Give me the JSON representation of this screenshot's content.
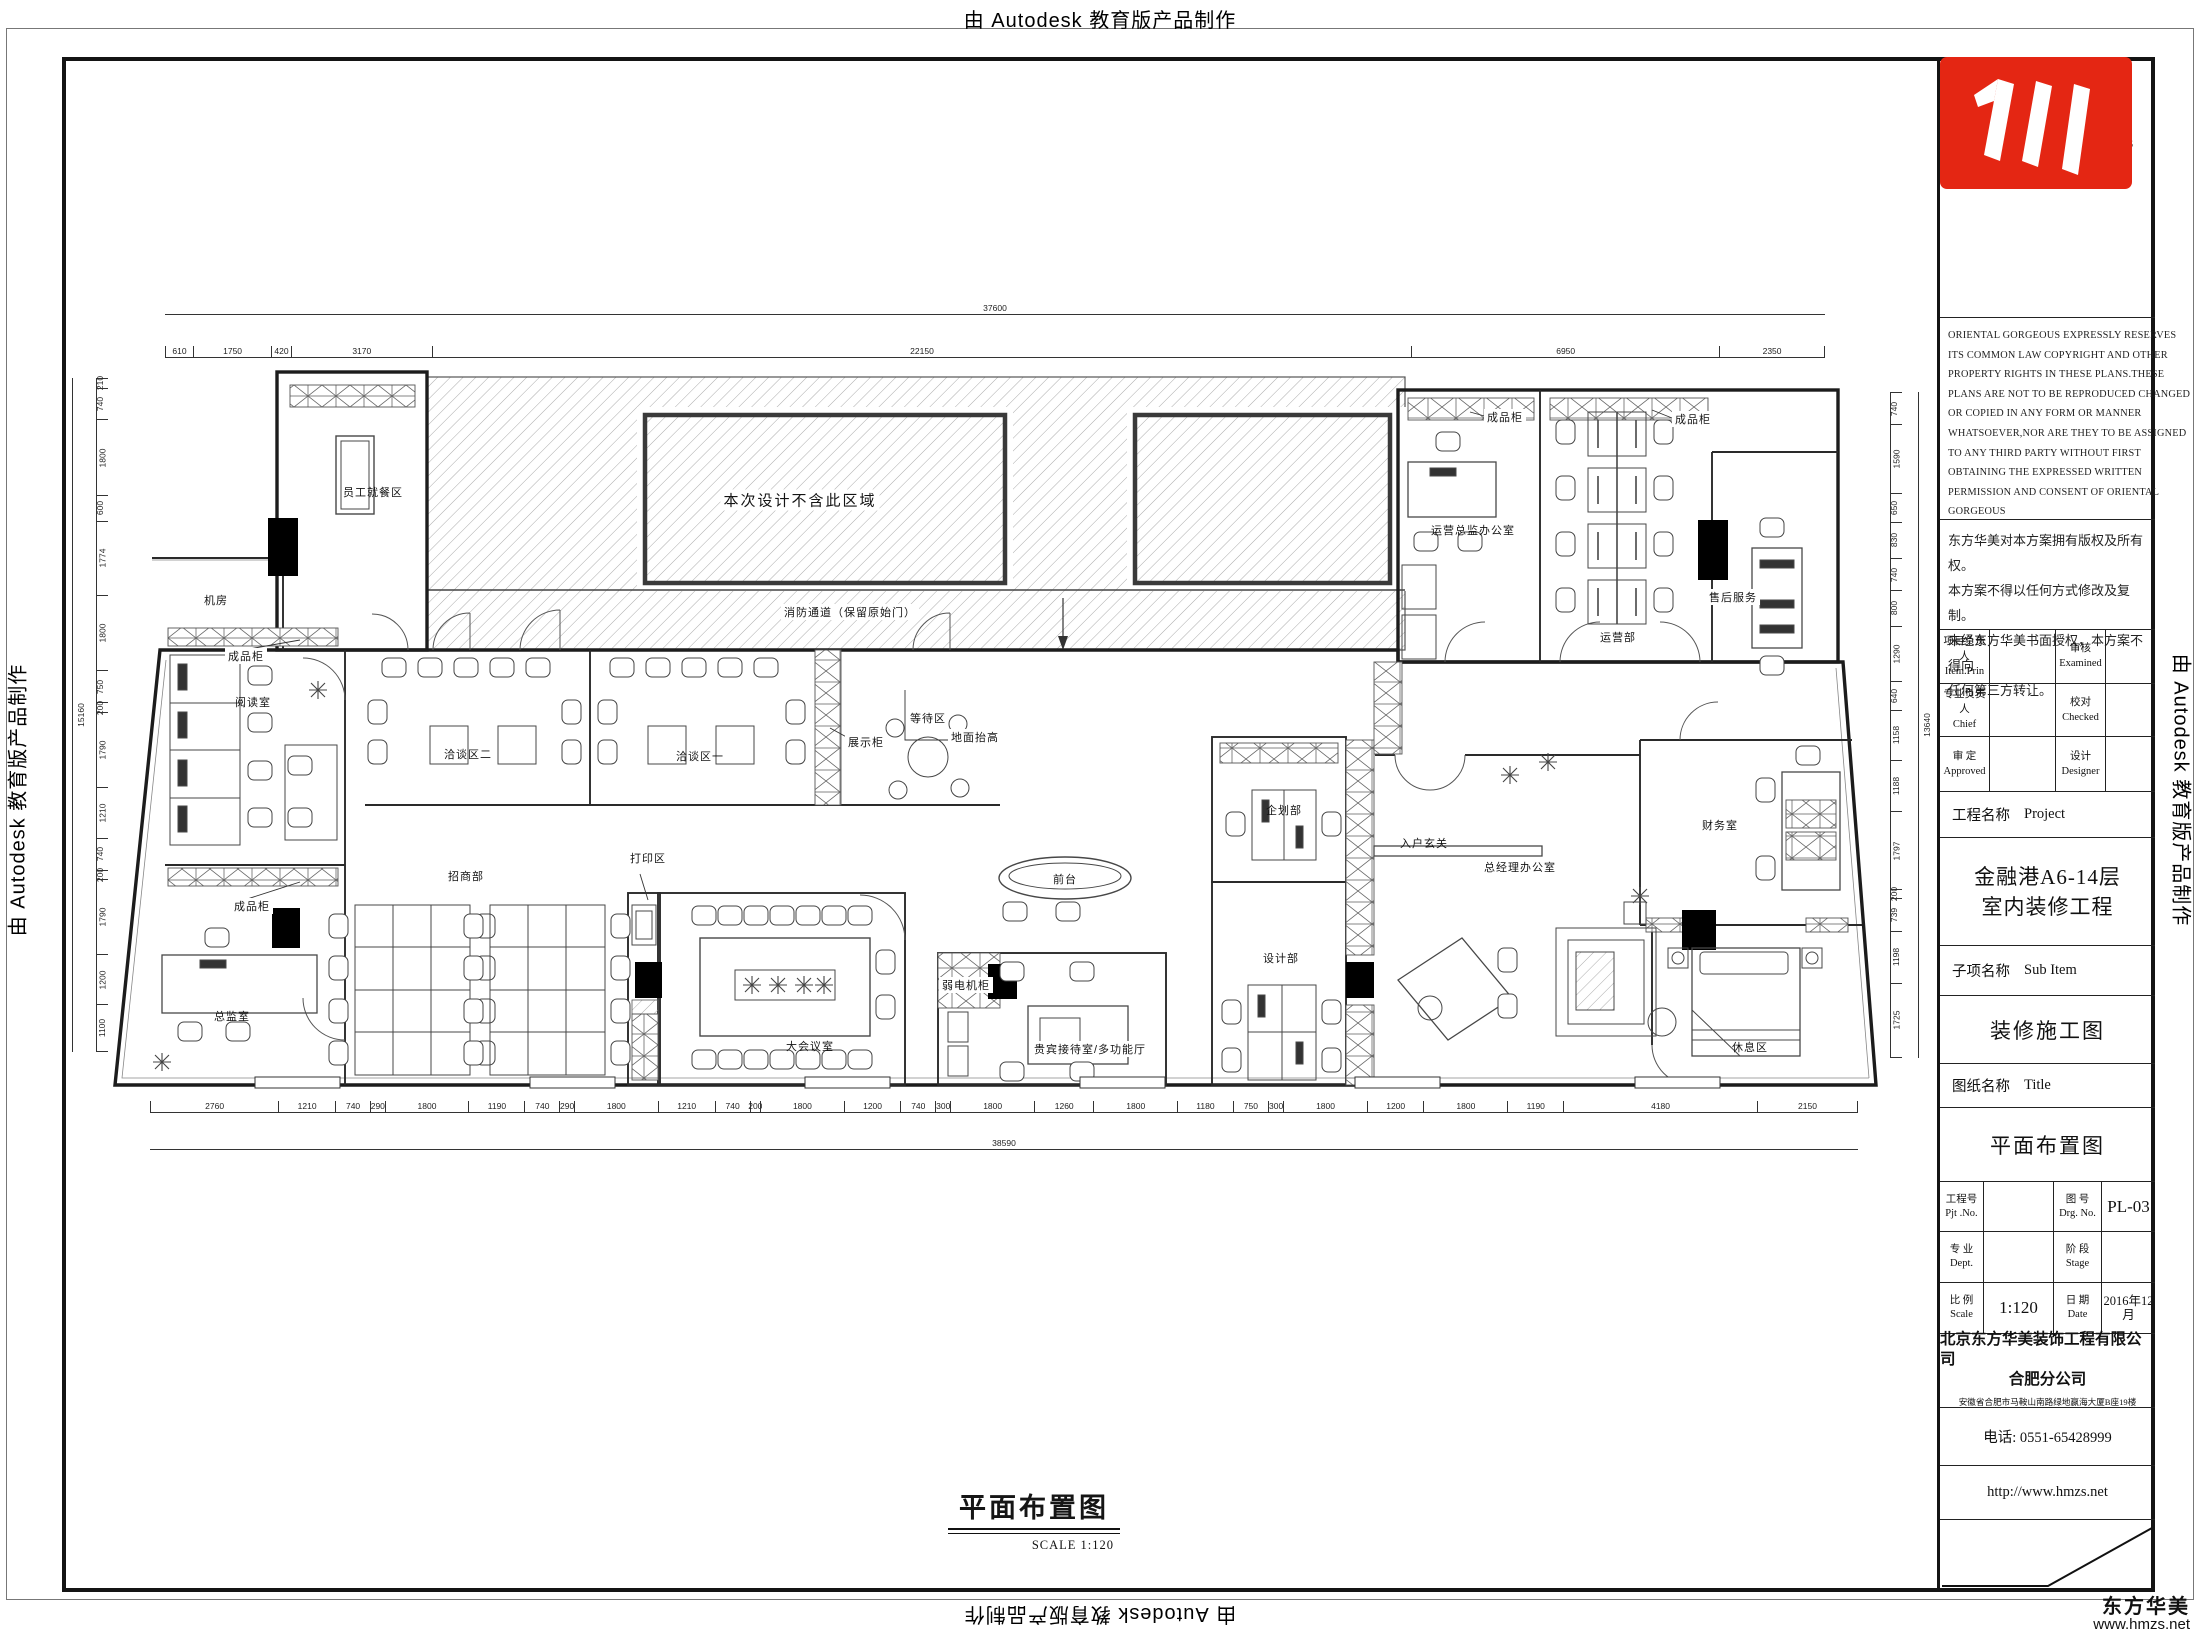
{
  "page": {
    "autodesk_credit": "由 Autodesk 教育版产品制作",
    "watermark_brand": "东方华美",
    "watermark_url": "www.hmzs.net"
  },
  "titleblock": {
    "logo_cn": "东方华美",
    "logo_en": "Oriental Gorgeous",
    "copyright_en_lines": [
      "ORIENTAL GORGEOUS EXPRESSLY RESERVES",
      "ITS COMMON LAW COPYRIGHT AND OTHER",
      "PROPERTY RIGHTS IN THESE PLANS.THESE",
      "PLANS ARE NOT TO BE REPRODUCED CHANGED",
      "OR COPIED IN ANY FORM OR MANNER",
      "WHATSOEVER,NOR ARE THEY TO BE ASSIGNED",
      "TO ANY THIRD PARTY WITHOUT FIRST",
      "OBTAINING THE EXPRESSED WRITTEN",
      "PERMISSION AND CONSENT OF ORIENTAL",
      "GORGEOUS"
    ],
    "copyright_cn_lines": [
      "东方华美对本方案拥有版权及所有权。",
      "本方案不得以任何方式修改及复制。",
      "未经东方华美书面授权，本方案不得向",
      "任何第三方转让。"
    ],
    "personnel": [
      {
        "l_cn": "项目负责人",
        "l_en": "Item.Prin",
        "l_val": "",
        "r_cn": "审核",
        "r_en": "Examined",
        "r_val": ""
      },
      {
        "l_cn": "专业负责人",
        "l_en": "Chief",
        "l_val": "",
        "r_cn": "校对",
        "r_en": "Checked",
        "r_val": ""
      },
      {
        "l_cn": "审 定",
        "l_en": "Approved",
        "l_val": "",
        "r_cn": "设计",
        "r_en": "Designer",
        "r_val": ""
      }
    ],
    "project_label_cn": "工程名称",
    "project_label_en": "Project",
    "project_name_line1": "金融港A6-14层",
    "project_name_line2": "室内装修工程",
    "subitem_label_cn": "子项名称",
    "subitem_label_en": "Sub Item",
    "subitem_name": "装修施工图",
    "sheet_label_cn": "图纸名称",
    "sheet_label_en": "Title",
    "sheet_name": "平面布置图",
    "meta": {
      "pjt_cn": "工程号",
      "pjt_en": "Pjt .No.",
      "pjt_value": "",
      "drg_cn": "图 号",
      "drg_en": "Drg. No.",
      "drg_value": "PL-03",
      "dept_cn": "专 业",
      "dept_en": "Dept.",
      "dept_value": "",
      "stage_cn": "阶 段",
      "stage_en": "Stage",
      "stage_value": "",
      "scale_cn": "比 例",
      "scale_en": "Scale",
      "scale_value": "1:120",
      "date_cn": "日 期",
      "date_en": "Date",
      "date_value": "2016年12月"
    },
    "company_line1": "北京东方华美装饰工程有限公司",
    "company_line2": "合肥分公司",
    "company_address": "安徽省合肥市马鞍山南路绿地赢海大厦B座19楼",
    "phone": "电话: 0551-65428999",
    "website": "http://www.hmzs.net",
    "brand_red": "#e42613"
  },
  "plan": {
    "footer_title": "平面布置图",
    "footer_scale": "SCALE  1:120",
    "labels": [
      {
        "text": "本次设计不含此区域",
        "x": 800,
        "y": 500,
        "bg": true,
        "big": true
      },
      {
        "text": "消防通道（保留原始门）",
        "x": 850,
        "y": 612,
        "bg": true
      },
      {
        "text": "员工就餐区",
        "x": 373,
        "y": 492
      },
      {
        "text": "机房",
        "x": 216,
        "y": 600
      },
      {
        "text": "成品柜",
        "x": 246,
        "y": 656,
        "bg": true
      },
      {
        "text": "阅读室",
        "x": 253,
        "y": 702
      },
      {
        "text": "成品柜",
        "x": 252,
        "y": 906,
        "bg": true
      },
      {
        "text": "总监室",
        "x": 232,
        "y": 1016
      },
      {
        "text": "招商部",
        "x": 466,
        "y": 876
      },
      {
        "text": "洽谈区二",
        "x": 468,
        "y": 754
      },
      {
        "text": "洽谈区一",
        "x": 700,
        "y": 756
      },
      {
        "text": "展示柜",
        "x": 866,
        "y": 742,
        "bg": true
      },
      {
        "text": "等待区",
        "x": 928,
        "y": 718
      },
      {
        "text": "打印区",
        "x": 648,
        "y": 858,
        "bg": true
      },
      {
        "text": "大会议室",
        "x": 810,
        "y": 1046
      },
      {
        "text": "前台",
        "x": 1065,
        "y": 879
      },
      {
        "text": "地面抬高",
        "x": 975,
        "y": 737,
        "bg": true
      },
      {
        "text": "贵宾接待室/多功能厅",
        "x": 1090,
        "y": 1049,
        "bg": true
      },
      {
        "text": "弱电机柜",
        "x": 966,
        "y": 985,
        "bg": true
      },
      {
        "text": "企划部",
        "x": 1284,
        "y": 810
      },
      {
        "text": "设计部",
        "x": 1281,
        "y": 958
      },
      {
        "text": "入户玄关",
        "x": 1424,
        "y": 843
      },
      {
        "text": "总经理办公室",
        "x": 1520,
        "y": 867
      },
      {
        "text": "运营总监办公室",
        "x": 1473,
        "y": 530
      },
      {
        "text": "运营部",
        "x": 1618,
        "y": 637
      },
      {
        "text": "售后服务",
        "x": 1733,
        "y": 597,
        "bg": true
      },
      {
        "text": "成品柜",
        "x": 1505,
        "y": 417,
        "bg": true
      },
      {
        "text": "成品柜",
        "x": 1693,
        "y": 419,
        "bg": true
      },
      {
        "text": "财务室",
        "x": 1720,
        "y": 825
      },
      {
        "text": "休息区",
        "x": 1750,
        "y": 1047
      }
    ],
    "dimensions": {
      "h_overalls": [
        {
          "x": 165,
          "y": 303,
          "w": 1660,
          "label": "37600"
        },
        {
          "x": 150,
          "y": 1138,
          "w": 1708,
          "label": "38590"
        }
      ],
      "h_chains": [
        {
          "x": 165,
          "y": 346,
          "w": 1660,
          "values": [
            "610",
            "1750",
            "420",
            "3170",
            "22150",
            "6950",
            "2350"
          ]
        },
        {
          "x": 150,
          "y": 1101,
          "w": 1708,
          "values": [
            "2760",
            "1210",
            "740",
            "290",
            "1800",
            "1190",
            "740",
            "290",
            "1800",
            "1210",
            "740",
            "200",
            "1800",
            "1200",
            "740",
            "300",
            "1800",
            "1260",
            "1800",
            "1180",
            "750",
            "300",
            "1800",
            "1200",
            "1800",
            "1190",
            "4180",
            "2150"
          ]
        }
      ],
      "v_overalls": [
        {
          "x": 72,
          "y": 378,
          "h": 674,
          "label": "15160"
        },
        {
          "x": 1918,
          "y": 392,
          "h": 666,
          "label": "13640"
        }
      ],
      "v_chains": [
        {
          "x": 96,
          "y": 378,
          "h": 674,
          "values": [
            "210",
            "740",
            "1800",
            "600",
            "1774",
            "1800",
            "750",
            "200",
            "1790",
            "1210",
            "740",
            "200",
            "1790",
            "1200",
            "1100"
          ]
        },
        {
          "x": 1890,
          "y": 392,
          "h": 666,
          "values": [
            "740",
            "1590",
            "650",
            "830",
            "740",
            "800",
            "1290",
            "640",
            "1158",
            "1188",
            "1797",
            "200",
            "739",
            "1198",
            "1725"
          ]
        }
      ]
    }
  }
}
